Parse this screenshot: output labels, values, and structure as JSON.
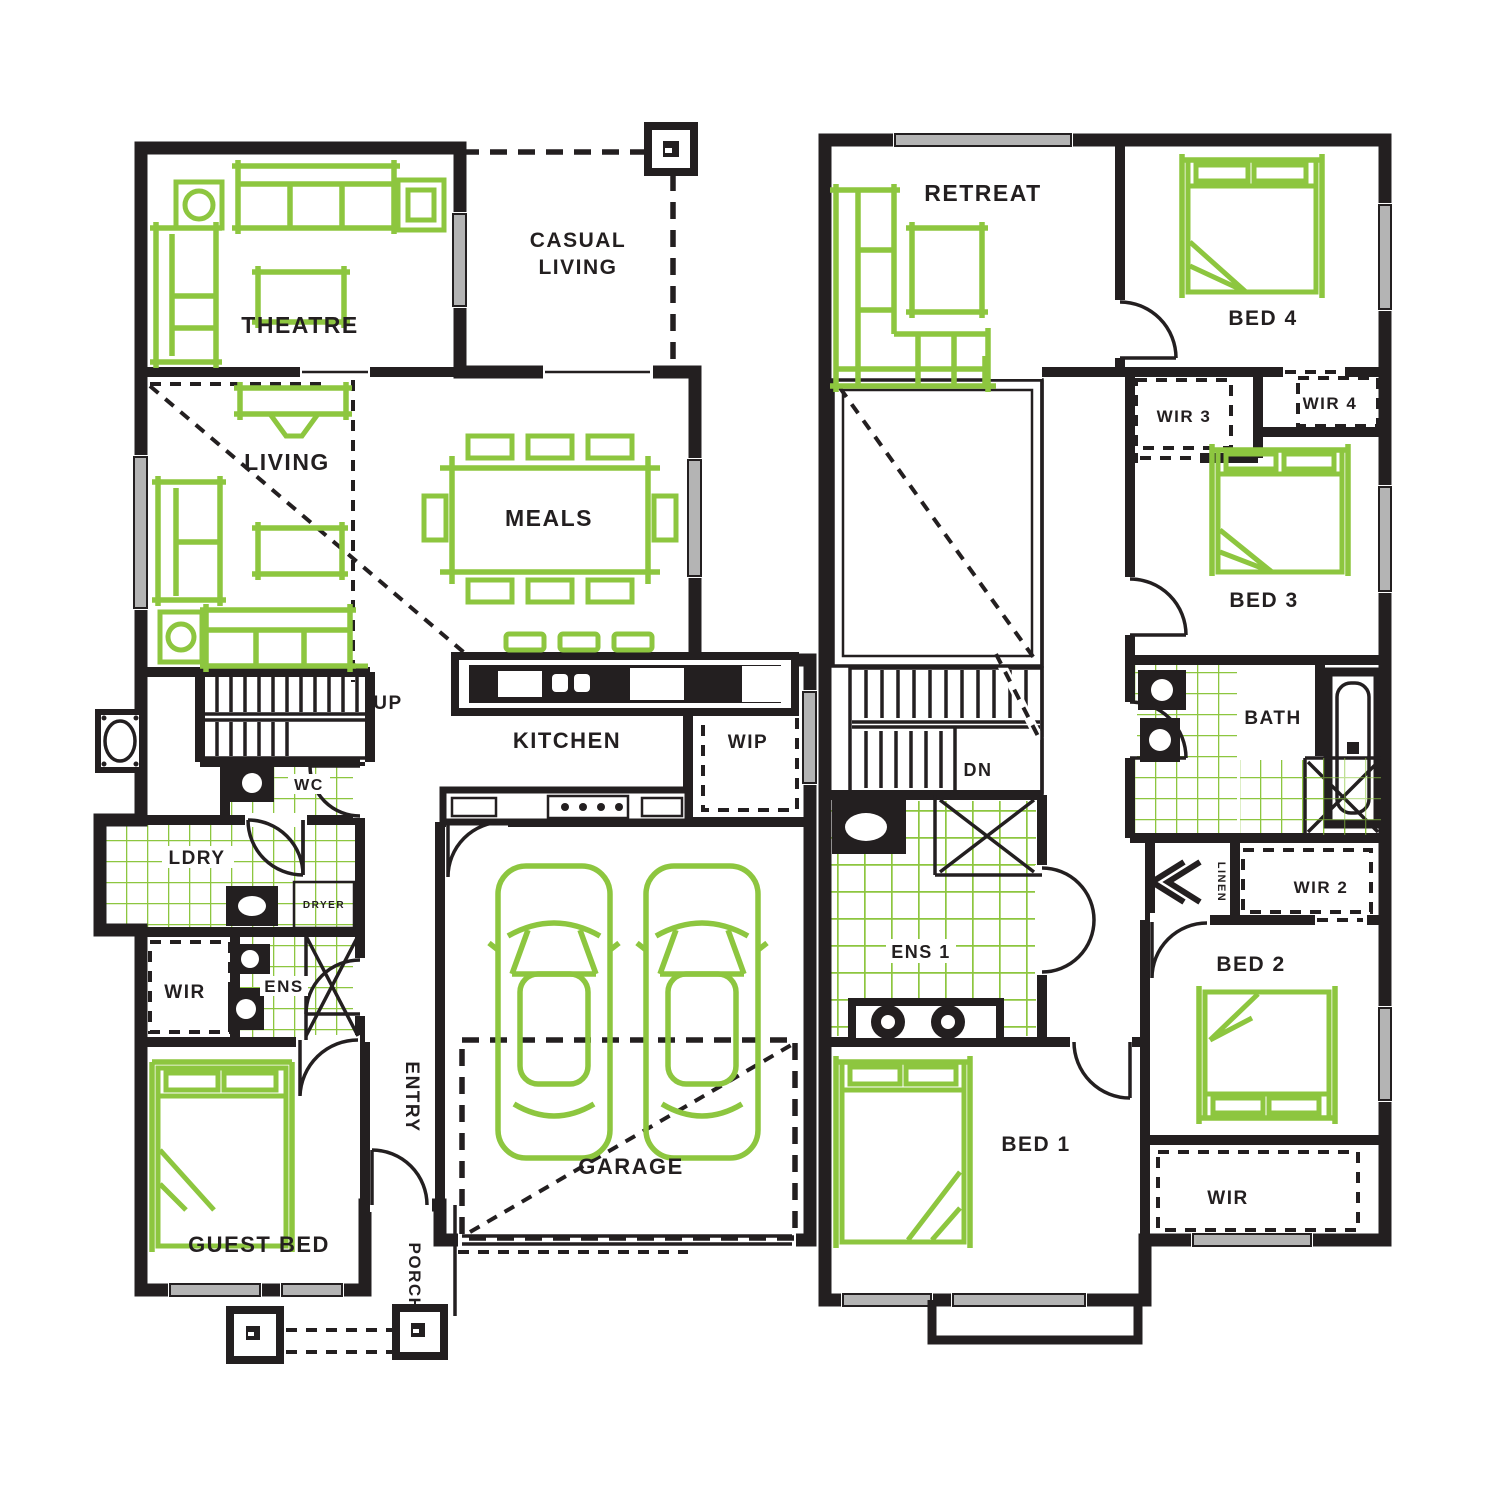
{
  "title": "Two storey house floor plan",
  "colors": {
    "wall": "#231f20",
    "furniture_accent": "#8dc63f",
    "tile_accent": "#8dc63f",
    "window": "#b4b4b4",
    "background": "#ffffff"
  },
  "ground_floor": {
    "theatre": "THEATRE",
    "casual_line1": "CASUAL",
    "casual_line2": "LIVING",
    "living": "LIVING",
    "meals": "MEALS",
    "kitchen": "KITCHEN",
    "wip": "WIP",
    "up": "UP",
    "wc": "WC",
    "ldry": "LDRY",
    "dryer": "DRYER",
    "wir": "WIR",
    "ens": "ENS",
    "guest_bed": "GUEST BED",
    "entry": "ENTRY",
    "porch": "PORCH",
    "garage": "GARAGE"
  },
  "upper_floor": {
    "retreat": "RETREAT",
    "bed4": "BED 4",
    "wir3": "WIR 3",
    "wir4": "WIR 4",
    "bed3": "BED 3",
    "bath": "BATH",
    "dn": "DN",
    "ens1": "ENS 1",
    "linen": "LINEN",
    "wir2": "WIR 2",
    "bed2": "BED 2",
    "wir": "WIR",
    "bed1": "BED 1"
  }
}
